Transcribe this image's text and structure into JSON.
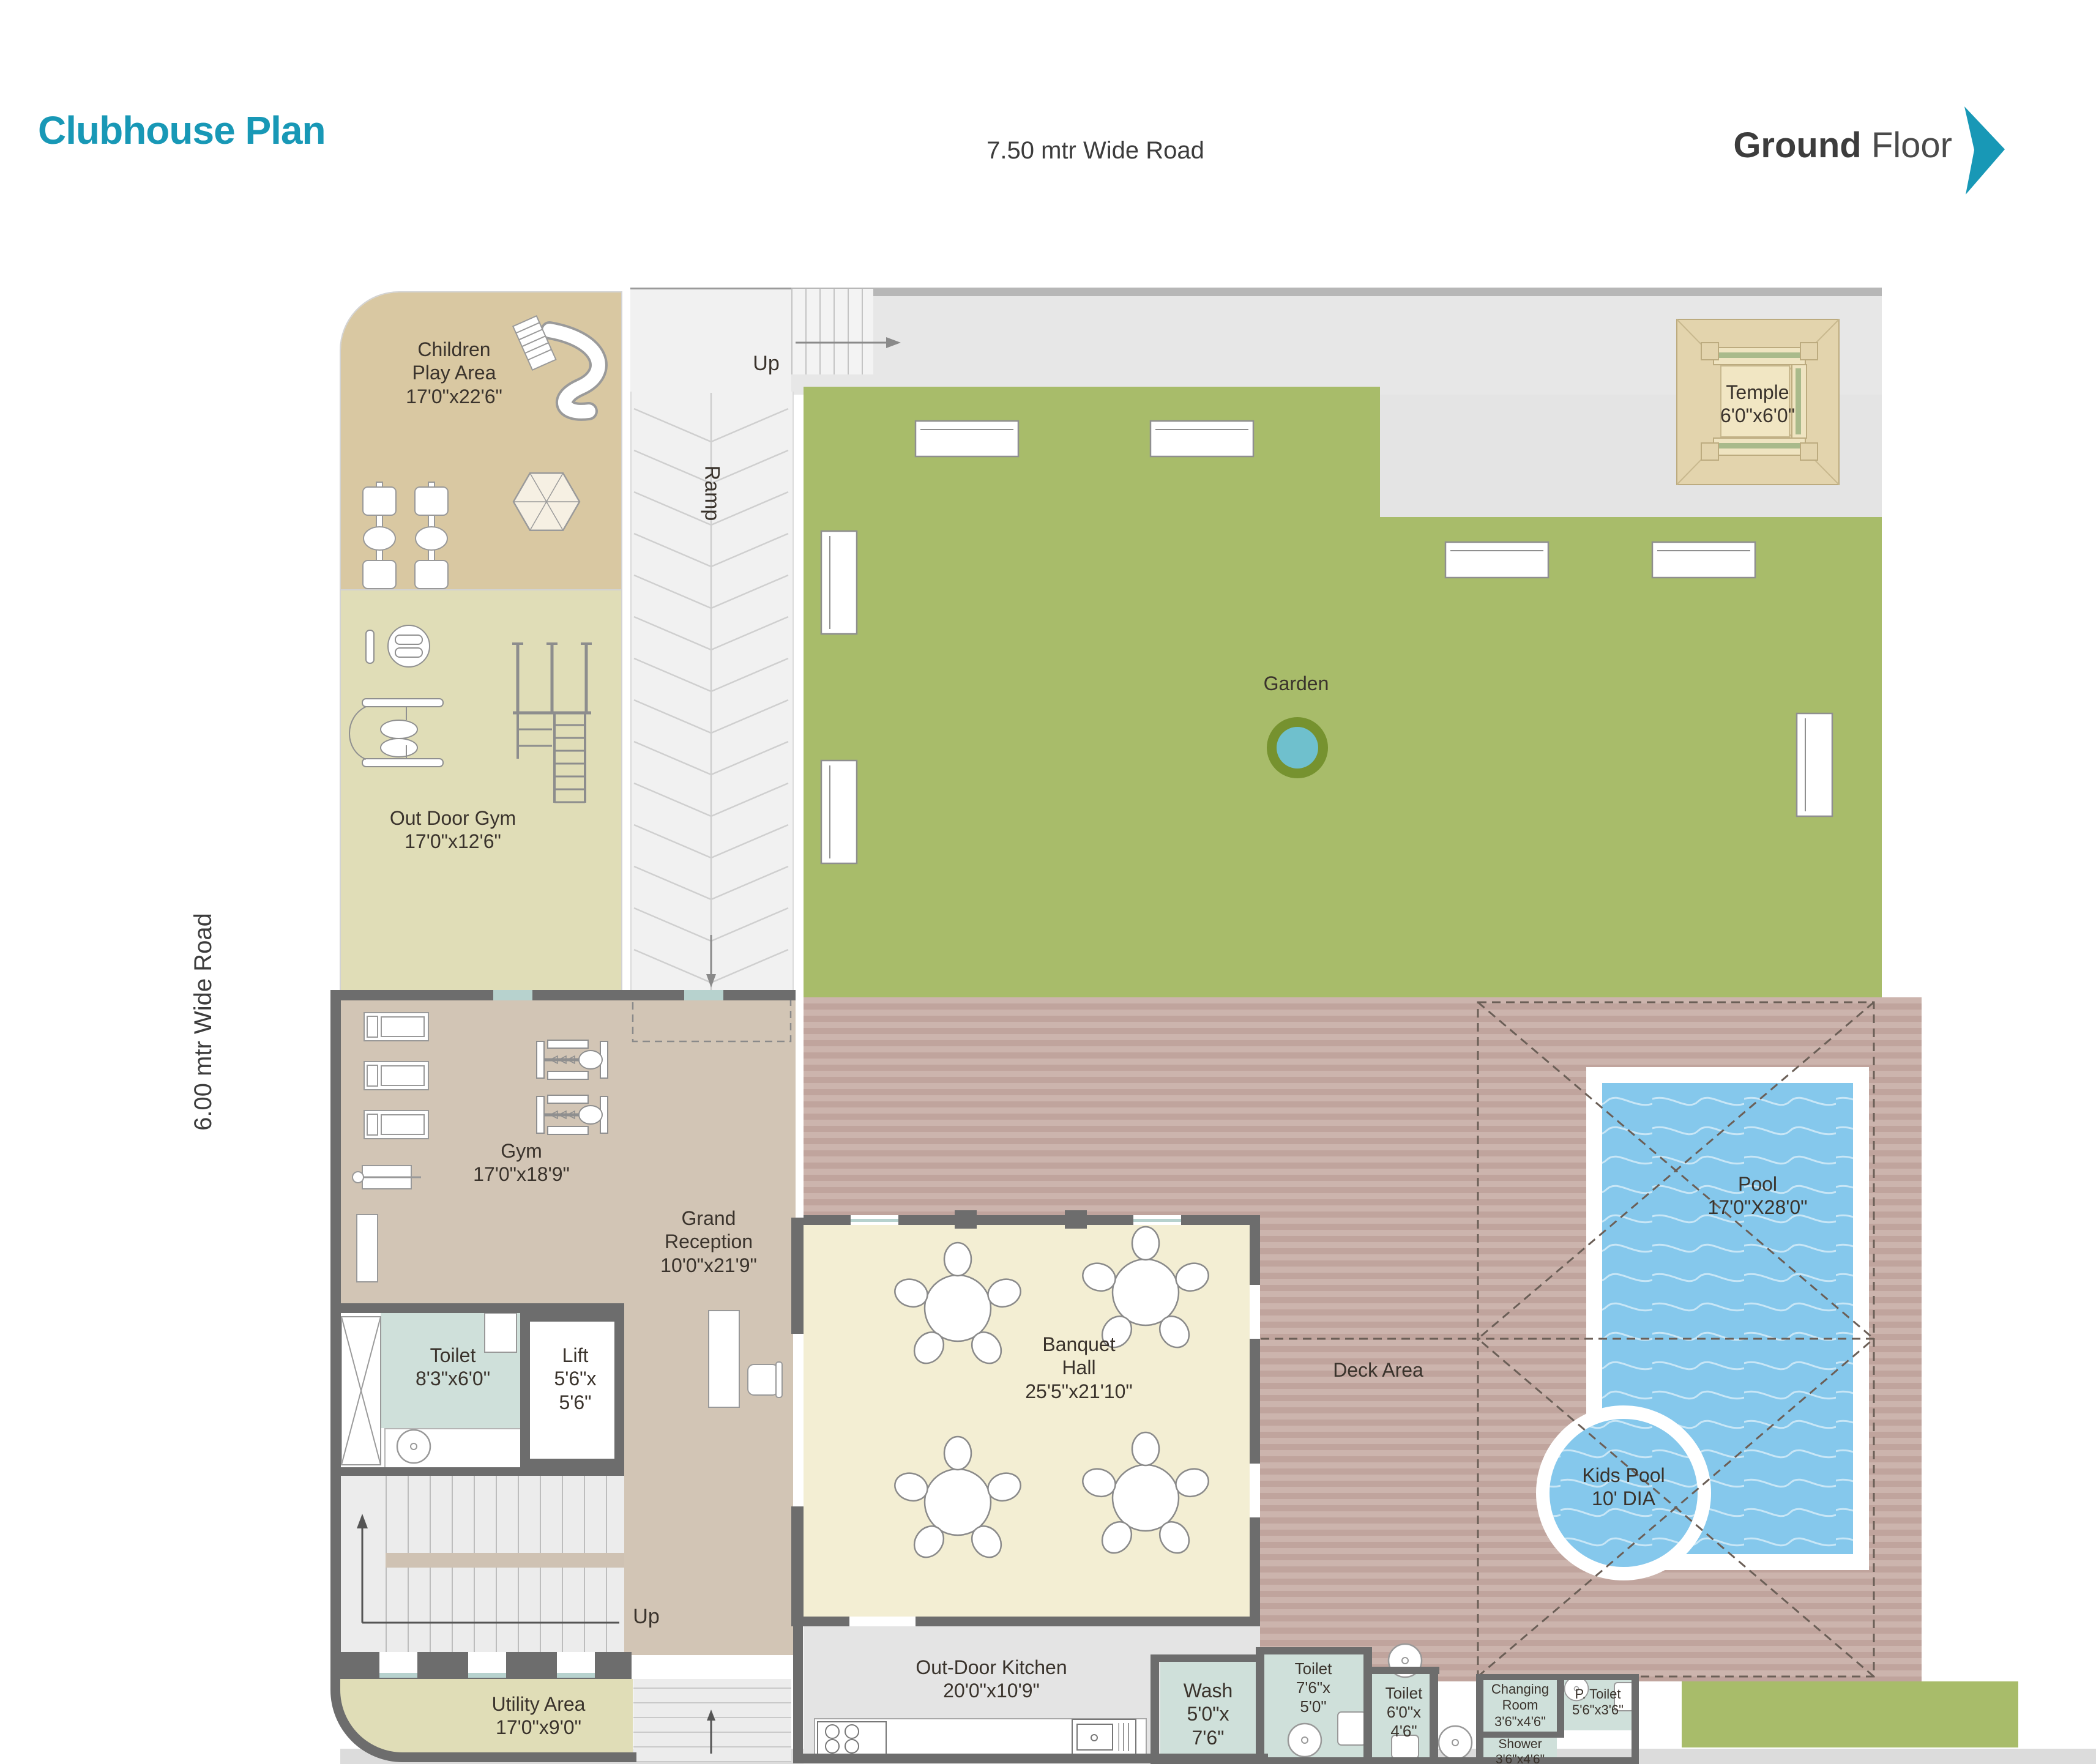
{
  "header": {
    "title": "Clubhouse Plan",
    "floor_bold": "Ground",
    "floor_light": "Floor",
    "road_top": "7.50 mtr Wide Road",
    "road_left": "6.00 mtr Wide Road"
  },
  "labels": {
    "up_top": "Up",
    "up_bottom": "Up",
    "ramp": "Ramp",
    "garden": "Garden",
    "deck": "Deck Area"
  },
  "rooms": {
    "children_play": {
      "lines": [
        "Children",
        "Play Area",
        "17'0\"x22'6\""
      ]
    },
    "outdoor_gym": {
      "lines": [
        "Out Door Gym",
        "17'0\"x12'6\""
      ]
    },
    "temple": {
      "lines": [
        "Temple",
        "6'0\"x6'0\""
      ]
    },
    "gym": {
      "lines": [
        "Gym",
        "17'0\"x18'9\""
      ]
    },
    "grand_reception": {
      "lines": [
        "Grand",
        "Reception",
        "10'0\"x21'9\""
      ]
    },
    "toilet_main": {
      "lines": [
        "Toilet",
        "8'3\"x6'0\""
      ]
    },
    "lift": {
      "lines": [
        "Lift",
        "5'6\"x",
        "5'6\""
      ]
    },
    "banquet_hall": {
      "lines": [
        "Banquet",
        "Hall",
        "25'5\"x21'10\""
      ]
    },
    "pool": {
      "lines": [
        "Pool",
        "17'0\"X28'0\""
      ]
    },
    "kids_pool": {
      "lines": [
        "Kids Pool",
        "10' DIA"
      ]
    },
    "utility": {
      "lines": [
        "Utility Area",
        "17'0\"x9'0\""
      ]
    },
    "outdoor_kitchen": {
      "lines": [
        "Out-Door Kitchen",
        "20'0\"x10'9\""
      ]
    },
    "wash": {
      "lines": [
        "Wash",
        "5'0\"x",
        "7'6\""
      ]
    },
    "toilet_76": {
      "lines": [
        "Toilet",
        "7'6\"x",
        "5'0\""
      ]
    },
    "toilet_60": {
      "lines": [
        "Toilet",
        "6'0\"x",
        "4'6\""
      ]
    },
    "changing_room": {
      "lines": [
        "Changing",
        "Room",
        "3'6\"x4'6\""
      ]
    },
    "p_toilet": {
      "lines": [
        "P. Toilet",
        "5'6\"x3'6\""
      ]
    },
    "shower": {
      "lines": [
        "Shower",
        "3'6\"x4'6\""
      ]
    }
  },
  "colors": {
    "accent": "#1898b6",
    "garden": "#a8bc6a",
    "pool_water": "#85c8ec",
    "deck_stripe_light": "#ccb4ad",
    "deck_stripe_dark": "#c0a49d",
    "play_area_tan": "#d9c8a2",
    "khaki": "#e0ddb7",
    "taupe": "#d2c5b5",
    "banquet_cream": "#f3eed3",
    "wet_room_teal": "#cfe0da",
    "wall_gray": "#6d6d6d"
  },
  "icons": [
    "slide-icon",
    "seesaw-icon",
    "umbrella-icon",
    "treadmill-icon",
    "exercise-machine-icon",
    "bench-icon",
    "fountain-icon",
    "stove-icon",
    "sink-icon",
    "wc-icon",
    "stairs-icon",
    "arrow-icon",
    "chevron-right-icon",
    "table-with-chairs-icon",
    "reception-desk-icon"
  ]
}
